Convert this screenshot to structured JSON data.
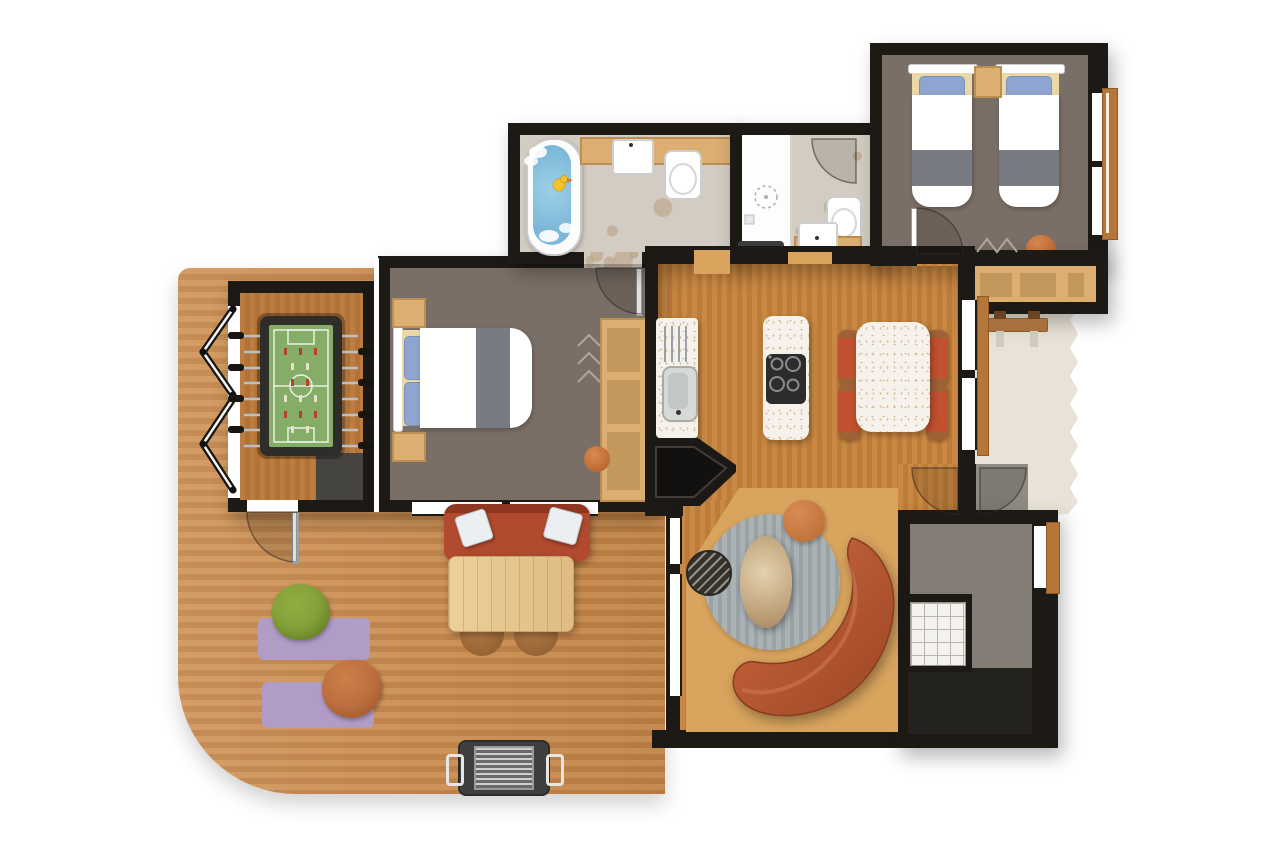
{
  "document": {
    "type": "floor-plan",
    "description": "Top-down illustrated floor plan of a holiday lodge with deck, games room, two bedrooms, two bathrooms, kitchen-diner, living area, utility room and patio"
  },
  "colors": {
    "wall": "#1d1a16",
    "deck_a": "#cf9254",
    "deck_b": "#c08044",
    "room_wood_a": "#c98944",
    "room_wood_b": "#bd7c3a",
    "bedroom_floor": "#7a6f66",
    "stone": "#d3ccc2",
    "patio": "#e9e3d7",
    "utility_floor": "#837d75",
    "vestibule_floor": "#8f8a83",
    "tan": "#dcae71",
    "tan_dark": "#c2985c",
    "water": "#7db8d8",
    "duck_yellow": "#f2c12e",
    "pillow_blue": "#8ea6cf",
    "blanket_gray": "#787c82",
    "cream": "#ead9a6",
    "sofa_red": "#b14a2e",
    "sofa_orange_a": "#cd6a40",
    "sofa_orange_b": "#9c4524",
    "chair_red": "#c2512f",
    "chair_arm": "#9f6136",
    "table_wood_a": "#ecd09b",
    "table_wood_b": "#dfbc82",
    "rug_gray_a": "#aab2b6",
    "rug_gray_b": "#9aa2a6",
    "tan_rug": "#d9a55e",
    "purple": "#b19bc7",
    "grill_body": "#3f3f3f",
    "foosball_green": "#85ad68",
    "foosball_frame": "#2f2d2a",
    "storage_dark": "#46443f",
    "sill": "#b5763a",
    "bean_green": "#86a23b",
    "bean_rust": "#bd6f3e"
  },
  "rooms": {
    "deck": {
      "label": "Wooden deck terrace"
    },
    "games_room": {
      "label": "Games room"
    },
    "bedroom_double": {
      "label": "Double bedroom"
    },
    "bathroom": {
      "label": "Bathroom with bathtub"
    },
    "shower_room": {
      "label": "Shower room"
    },
    "bedroom_twin": {
      "label": "Twin bedroom"
    },
    "kitchen_dining": {
      "label": "Kitchen and dining area"
    },
    "living_area": {
      "label": "Living area"
    },
    "utility_room": {
      "label": "Utility room"
    },
    "entrance_vestibule": {
      "label": "Entrance vestibule"
    },
    "patio": {
      "label": "Gravel patio"
    }
  },
  "furniture": {
    "foosball_table": {
      "label": "Foosball table"
    },
    "games_storage": {
      "label": "Storage unit"
    },
    "folding_doors": {
      "label": "Folding doors to deck"
    },
    "double_bed": {
      "label": "Double bed"
    },
    "nightstand": {
      "label": "Nightstand"
    },
    "wardrobe_double": {
      "label": "Wardrobe with shelves"
    },
    "bathtub": {
      "label": "Bathtub with rubber duck"
    },
    "vanity_sink": {
      "label": "Vanity sink"
    },
    "toilet": {
      "label": "Toilet"
    },
    "shower": {
      "label": "Walk-in shower"
    },
    "shower_sink": {
      "label": "Hand basin"
    },
    "twin_beds": {
      "label": "Two twin beds"
    },
    "wardrobe_twin": {
      "label": "Wardrobe bench"
    },
    "kitchen_counter": {
      "label": "Kitchen counter with sink and drainer"
    },
    "cooking_island": {
      "label": "Island with four-burner cooktop"
    },
    "dining_table": {
      "label": "Dining table with four chairs"
    },
    "fireplace": {
      "label": "Corner fireplace"
    },
    "curved_sofa": {
      "label": "Curved lounge sofa"
    },
    "round_rug": {
      "label": "Round striped rug"
    },
    "stone_coffee_table": {
      "label": "Stone coffee table"
    },
    "patterned_pouf": {
      "label": "Patterned pouf"
    },
    "orange_pouf": {
      "label": "Orange pouf"
    },
    "outdoor_sofa": {
      "label": "Outdoor sofa with cushions"
    },
    "outdoor_table": {
      "label": "Outdoor dining table"
    },
    "outdoor_chair": {
      "label": "Outdoor chair"
    },
    "yoga_mat": {
      "label": "Lounge mat"
    },
    "green_beanbag": {
      "label": "Green beanbag"
    },
    "rust_beanbag": {
      "label": "Rust beanbag"
    },
    "barbecue_grill": {
      "label": "Barbecue grill"
    },
    "garden_bench": {
      "label": "Garden bench"
    },
    "tile_unit": {
      "label": "Tiled washing unit"
    },
    "doormat": {
      "label": "Doormat"
    }
  }
}
